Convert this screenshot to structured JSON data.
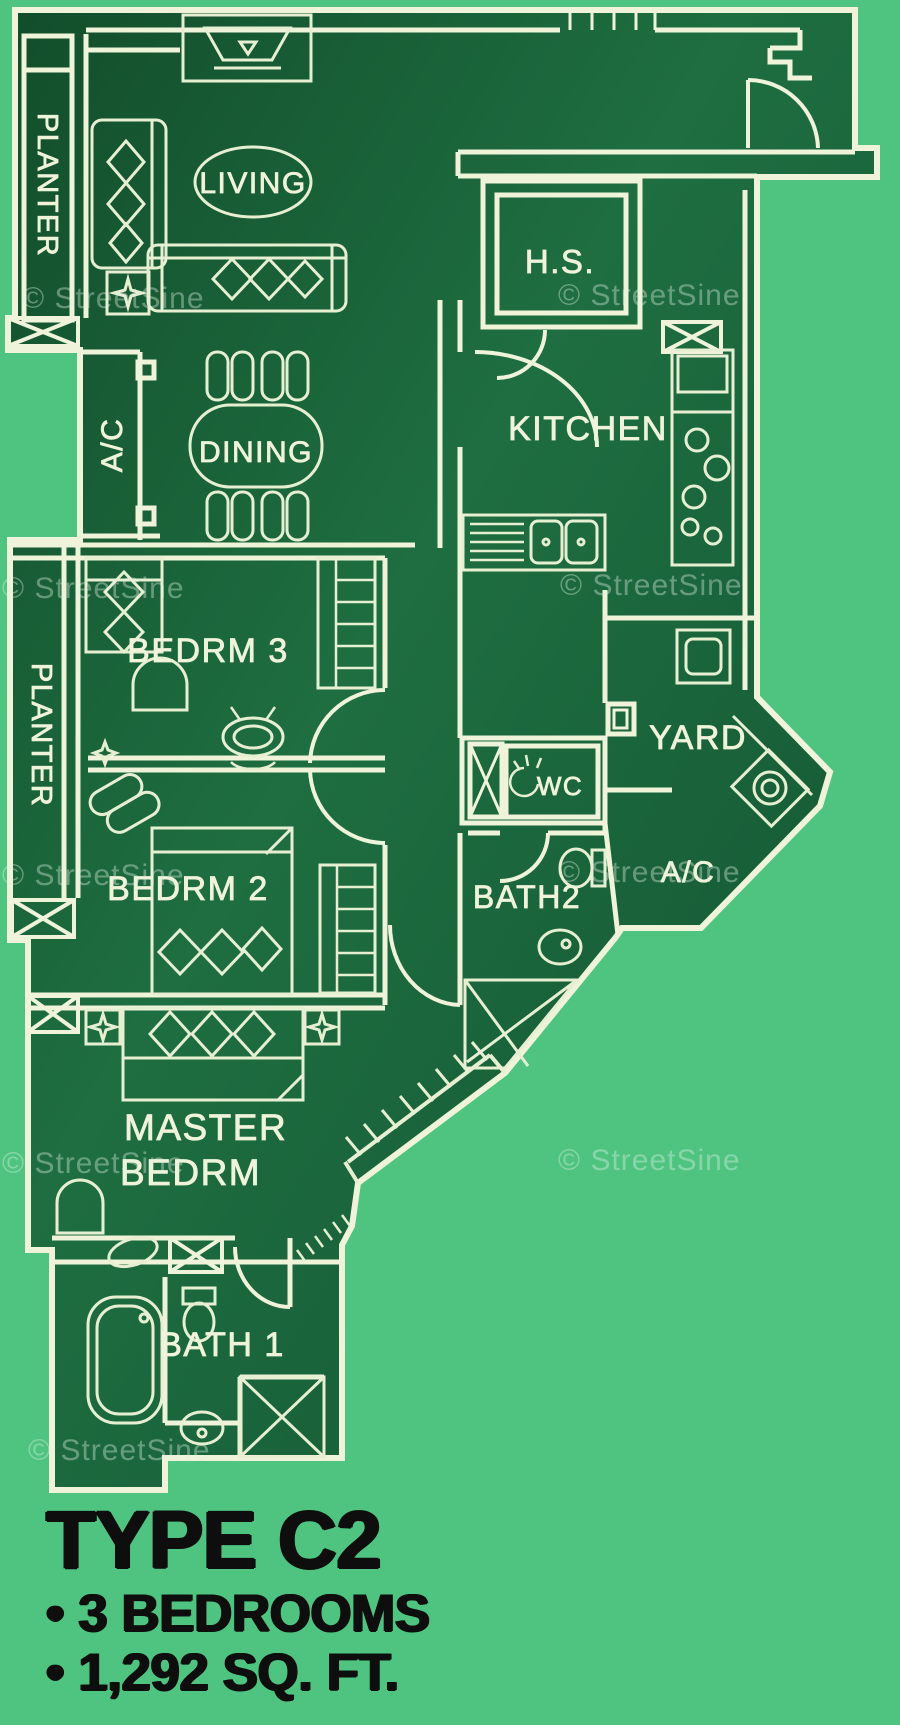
{
  "plan": {
    "watermark_text": "© StreetSine",
    "labels": {
      "planter_top": "PLANTER",
      "living": "LIVING",
      "hs": "H.S.",
      "kitchen": "KITCHEN",
      "ac_left": "A/C",
      "dining": "DINING",
      "bedrm3": "BEDRM 3",
      "planter_left": "PLANTER",
      "yard": "YARD",
      "wc": "WC",
      "ac_right": "A/C",
      "bedrm2": "BEDRM 2",
      "bath2": "BATH2",
      "master_line1": "MASTER",
      "master_line2": "BEDRM",
      "bath1": "BATH 1"
    }
  },
  "footer": {
    "title": "TYPE C2",
    "bullets": [
      "• 3 BEDROOMS",
      "• 1,292 SQ. FT."
    ]
  },
  "colors": {
    "background": "#4fc481",
    "plan_fill": "#175c35",
    "line": "#eef3d9",
    "footer_text": "#0e0e0e"
  }
}
